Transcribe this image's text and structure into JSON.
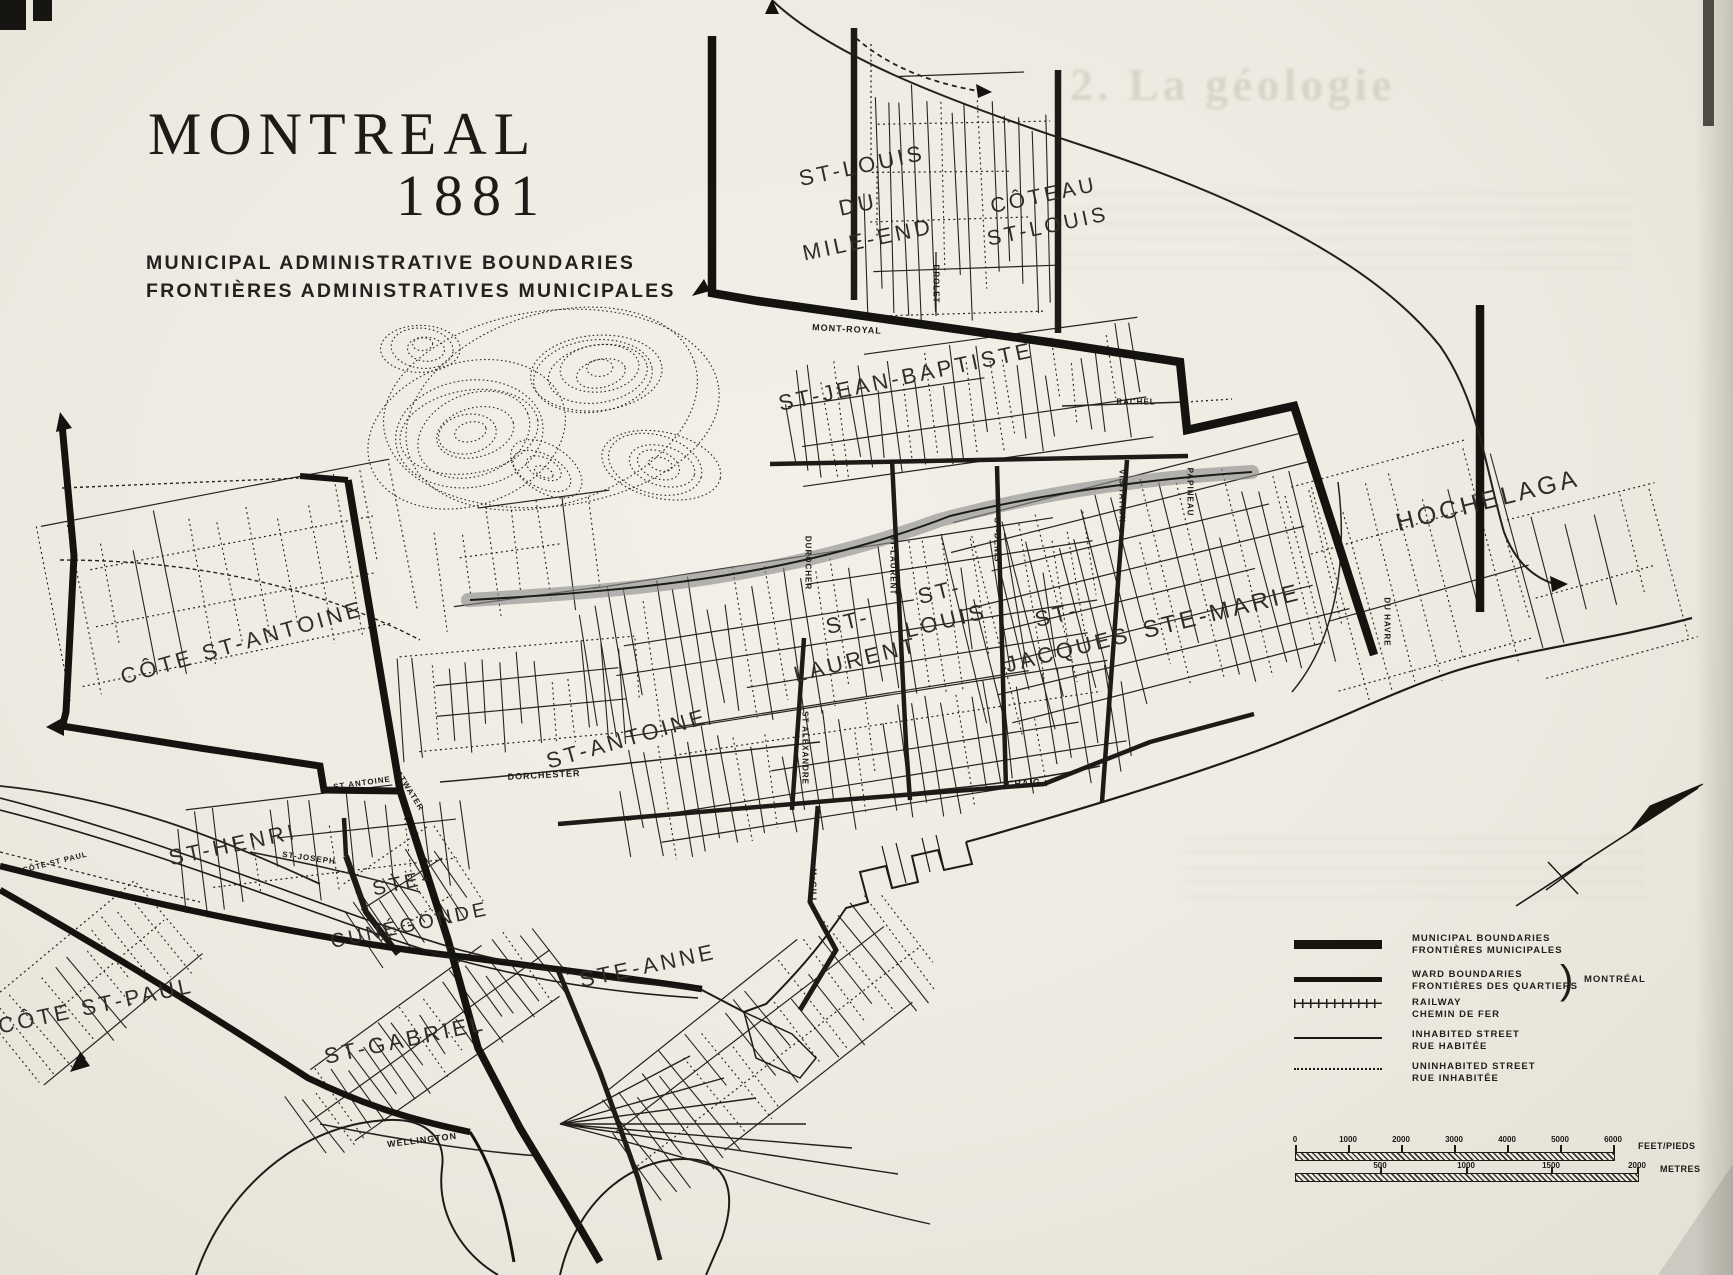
{
  "title": {
    "line1": "MONTREAL",
    "line2": "1881",
    "sub1": "MUNICIPAL  ADMINISTRATIVE  BOUNDARIES",
    "sub2": "FRONTIÈRES  ADMINISTRATIVES  MUNICIPALES"
  },
  "ghost_text": "2. La géologie",
  "colors": {
    "paper": "#edeae1",
    "ink": "#1b1a17",
    "highlight_band": "#8a8a8a"
  },
  "wards": [
    {
      "id": "st-louis-mile-end-1",
      "label": "ST-LOUIS",
      "x": 862,
      "y": 166,
      "rot": -12,
      "size": 22
    },
    {
      "id": "st-louis-mile-end-2",
      "label": "DU",
      "x": 858,
      "y": 205,
      "rot": -12,
      "size": 22
    },
    {
      "id": "st-louis-mile-end-3",
      "label": "MILE-END",
      "x": 868,
      "y": 240,
      "rot": -12,
      "size": 22
    },
    {
      "id": "coteau-st-louis-1",
      "label": "CÔTEAU",
      "x": 1044,
      "y": 196,
      "rot": -12,
      "size": 21
    },
    {
      "id": "coteau-st-louis-2",
      "label": "ST-LOUIS",
      "x": 1048,
      "y": 227,
      "rot": -12,
      "size": 21
    },
    {
      "id": "st-jean-baptiste",
      "label": "ST-JEAN-BAPTISTE",
      "x": 906,
      "y": 377,
      "rot": -12,
      "size": 22
    },
    {
      "id": "hochelaga",
      "label": "HOCHELAGA",
      "x": 1488,
      "y": 501,
      "rot": -14,
      "size": 25
    },
    {
      "id": "ste-marie",
      "label": "STE-MARIE",
      "x": 1222,
      "y": 612,
      "rot": -14,
      "size": 24
    },
    {
      "id": "st-jacques-1",
      "label": "ST-",
      "x": 1057,
      "y": 615,
      "rot": -14,
      "size": 22
    },
    {
      "id": "st-jacques-2",
      "label": "JACQUES",
      "x": 1068,
      "y": 650,
      "rot": -14,
      "size": 22
    },
    {
      "id": "st-louis-ward-1",
      "label": "ST-",
      "x": 940,
      "y": 592,
      "rot": -14,
      "size": 22
    },
    {
      "id": "st-louis-ward-2",
      "label": "LOUIS",
      "x": 946,
      "y": 621,
      "rot": -14,
      "size": 22
    },
    {
      "id": "st-laurent-ward-1",
      "label": "ST-",
      "x": 848,
      "y": 622,
      "rot": -14,
      "size": 22
    },
    {
      "id": "st-laurent-ward-2",
      "label": "LAURENT",
      "x": 856,
      "y": 660,
      "rot": -14,
      "size": 22
    },
    {
      "id": "st-antoine-ward",
      "label": "ST-ANTOINE",
      "x": 627,
      "y": 739,
      "rot": -16,
      "size": 22
    },
    {
      "id": "cote-st-antoine",
      "label": "CÔTE  ST-ANTOINE",
      "x": 242,
      "y": 643,
      "rot": -16,
      "size": 22
    },
    {
      "id": "st-henri",
      "label": "ST-HENRI",
      "x": 233,
      "y": 845,
      "rot": -12,
      "size": 22
    },
    {
      "id": "ste-cunegonde-1",
      "label": "STE-",
      "x": 402,
      "y": 884,
      "rot": -12,
      "size": 20
    },
    {
      "id": "ste-cunegonde-2",
      "label": "CUNÉGONDE",
      "x": 410,
      "y": 926,
      "rot": -12,
      "size": 20
    },
    {
      "id": "cote-st-paul",
      "label": "CÔTE  ST-PAUL",
      "x": 96,
      "y": 1006,
      "rot": -12,
      "size": 22
    },
    {
      "id": "st-gabriel",
      "label": "ST-GABRIEL",
      "x": 405,
      "y": 1040,
      "rot": -12,
      "size": 22
    },
    {
      "id": "ste-anne",
      "label": "STE-ANNE",
      "x": 648,
      "y": 966,
      "rot": -12,
      "size": 22
    }
  ],
  "streets": [
    {
      "id": "mont-royal",
      "label": "MONT-ROYAL",
      "x": 847,
      "y": 329,
      "rot": 3,
      "size": 9
    },
    {
      "id": "rachel",
      "label": "RACHEL",
      "x": 1136,
      "y": 402,
      "rot": 0,
      "size": 8
    },
    {
      "id": "drolet",
      "label": "DROLET",
      "x": 936,
      "y": 284,
      "rot": 90,
      "size": 8
    },
    {
      "id": "durocher",
      "label": "DUROCHER",
      "x": 808,
      "y": 563,
      "rot": 90,
      "size": 8
    },
    {
      "id": "st-laurent-st",
      "label": "ST-LAURENT",
      "x": 893,
      "y": 565,
      "rot": 90,
      "size": 8
    },
    {
      "id": "st-denis",
      "label": "ST-DENIS",
      "x": 997,
      "y": 540,
      "rot": 90,
      "size": 8
    },
    {
      "id": "visitation",
      "label": "VISITATION",
      "x": 1122,
      "y": 496,
      "rot": 90,
      "size": 8
    },
    {
      "id": "papineau",
      "label": "PAPINEAU",
      "x": 1190,
      "y": 492,
      "rot": 90,
      "size": 8
    },
    {
      "id": "du-havre",
      "label": "DU HAVRE",
      "x": 1387,
      "y": 622,
      "rot": 90,
      "size": 8
    },
    {
      "id": "st-alexandre",
      "label": "ST ALEXANDRE",
      "x": 805,
      "y": 748,
      "rot": 90,
      "size": 8
    },
    {
      "id": "mcgill",
      "label": "McGILL",
      "x": 813,
      "y": 886,
      "rot": 90,
      "size": 8
    },
    {
      "id": "dorchester",
      "label": "DORCHESTER",
      "x": 544,
      "y": 775,
      "rot": -3,
      "size": 9
    },
    {
      "id": "craig",
      "label": "CRAIG",
      "x": 1024,
      "y": 783,
      "rot": -4,
      "size": 9
    },
    {
      "id": "st-antoine-st",
      "label": "ST ANTOINE",
      "x": 362,
      "y": 783,
      "rot": -8,
      "size": 8
    },
    {
      "id": "atwater",
      "label": "ATWATER",
      "x": 410,
      "y": 791,
      "rot": 58,
      "size": 8
    },
    {
      "id": "st-joseph",
      "label": "ST-JOSEPH",
      "x": 309,
      "y": 858,
      "rot": 8,
      "size": 8
    },
    {
      "id": "cote-st-paul-road",
      "label": "CÔTE ST PAUL",
      "x": 55,
      "y": 862,
      "rot": -14,
      "size": 7.5
    },
    {
      "id": "wellington",
      "label": "WELLINGTON",
      "x": 422,
      "y": 1140,
      "rot": -7,
      "size": 9
    }
  ],
  "legend": {
    "items": [
      {
        "key": "municipal",
        "label1": "MUNICIPAL  BOUNDARIES",
        "label2": "FRONTIÈRES  MUNICIPALES"
      },
      {
        "key": "ward",
        "label1": "WARD  BOUNDARIES",
        "label2": "FRONTIÈRES  DES  QUARTIERS"
      },
      {
        "key": "railway",
        "label1": "RAILWAY",
        "label2": "CHEMIN  DE  FER"
      },
      {
        "key": "inhabited",
        "label1": "INHABITED  STREET",
        "label2": "RUE  HABITÉE"
      },
      {
        "key": "uninhabited",
        "label1": "UNINHABITED  STREET",
        "label2": "RUE  INHABITÉE"
      }
    ],
    "brace": ")",
    "note": "MONTRÉAL"
  },
  "scalebar": {
    "feet_ticks": [
      "0",
      "1000",
      "2000",
      "3000",
      "4000",
      "5000",
      "6000"
    ],
    "feet_unit": "FEET/PIEDS",
    "metre_ticks": [
      "500",
      "1000",
      "1500",
      "2000"
    ],
    "metre_unit": "METRES"
  }
}
